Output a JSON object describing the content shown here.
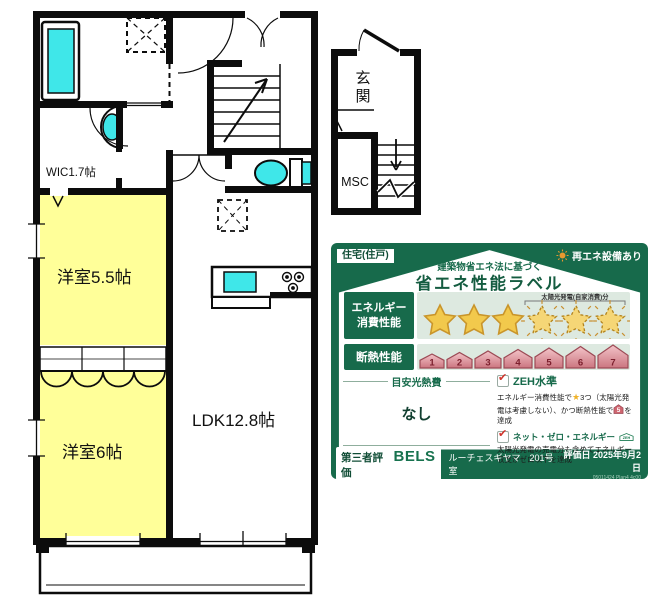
{
  "floorplan": {
    "rooms": {
      "wic": "WIC1.7帖",
      "bedroom_55": "洋室5.5帖",
      "bedroom_6": "洋室6帖",
      "ldk": "LDK12.8帖",
      "entrance_chars": [
        "玄",
        "関"
      ],
      "msc": "MSC"
    },
    "colors": {
      "room_fill": "#ffff99",
      "fixture_fill": "#3fe7e9",
      "wall": "#0c0c0c"
    }
  },
  "energy_label": {
    "housing_type": "住宅(住戸)",
    "renewable_badge": "再エネ設備あり",
    "law_subtitle": "建築物省エネ法に基づく",
    "title": "省エネ性能ラベル",
    "check_glyph": "✔",
    "energy": {
      "label_line1": "エネルギー",
      "label_line2": "消費性能",
      "stars_filled": 3,
      "stars_solar": 3,
      "solar_note": "太陽光発電(自家消費)分"
    },
    "insulation": {
      "label": "断熱性能",
      "levels": [
        "1",
        "2",
        "3",
        "4",
        "5",
        "6",
        "7"
      ]
    },
    "cost": {
      "heading": "目安光熱費",
      "value": "なし"
    },
    "zeh_standard": {
      "title": "ZEH水準",
      "star_icon": "★",
      "text1": "エネルギー消費性能で",
      "text2": "3つ（太陽光発電は考慮しない）、かつ断熱性能で",
      "house_level": "5",
      "text3": "を達成"
    },
    "net_zero": {
      "title": "ネット・ゼロ・エネルギー",
      "badge": "ZEH",
      "text": "太陽光発電の売電分も含めてエネルギー収支がゼロ以下を達成"
    },
    "footer": {
      "certifier": "第三者評価",
      "brand": "BELS",
      "building": "ルーチェスギヤマ　201号室",
      "eval_date": "評価日 2025年9月2日",
      "code": "05011424 Plan4 4c00"
    },
    "colors": {
      "dark_green": "#176a4b",
      "light_green": "#dde9e0",
      "star_gold": "#f2c94c",
      "house_pink": "#d4848e"
    }
  }
}
